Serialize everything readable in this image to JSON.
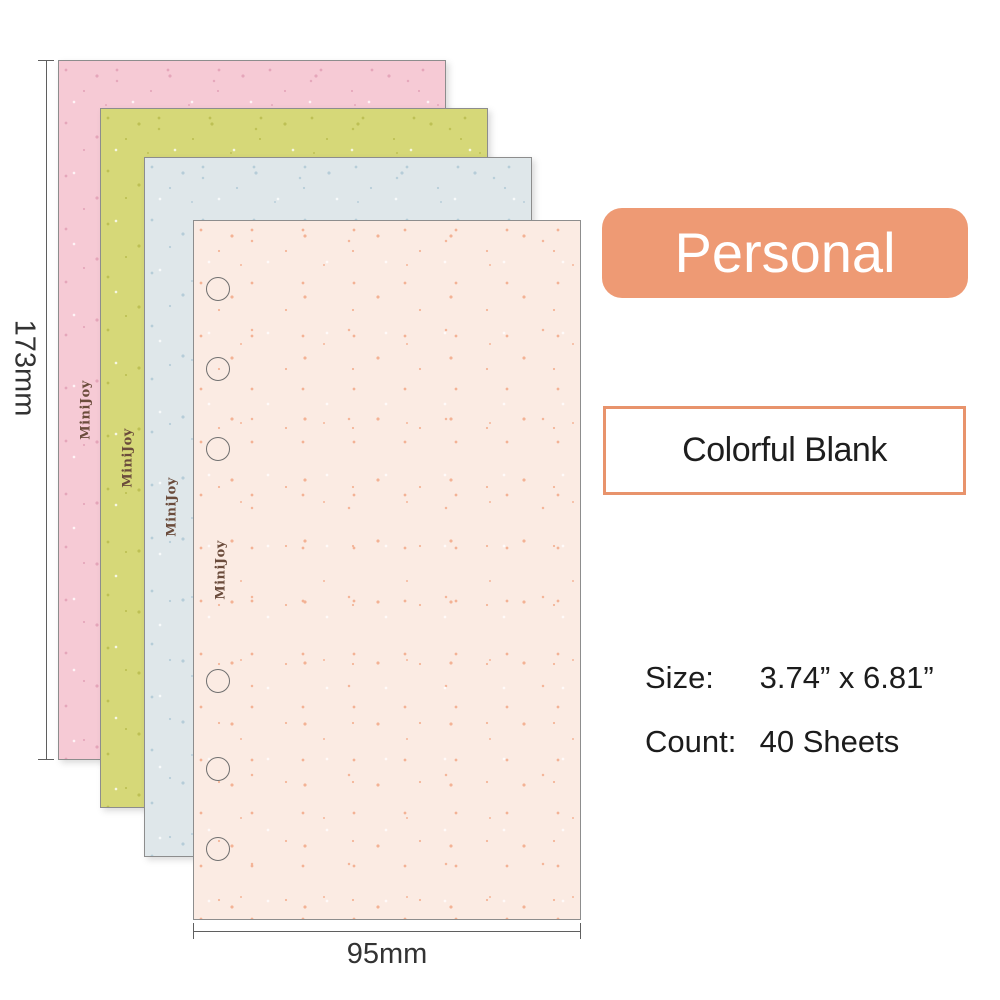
{
  "badge": {
    "label": "Personal",
    "bg": "#EE9A74",
    "text_color": "#FFFFFF"
  },
  "variant_box": {
    "label": "Colorful Blank",
    "border_color": "#E8936C"
  },
  "specs": {
    "size_label": "Size:",
    "size_value": "3.74” x 6.81”",
    "count_label": "Count:",
    "count_value": "40 Sheets"
  },
  "dimensions": {
    "height_label": "173mm",
    "width_label": "95mm"
  },
  "sheets": [
    {
      "brand": "MiniJoy",
      "color_name": "pink",
      "bg": "#F6CAD5",
      "speckle": "#E3A0B6"
    },
    {
      "brand": "MiniJoy",
      "color_name": "olive-green",
      "bg": "#D6D878",
      "speckle": "#B9BC4E"
    },
    {
      "brand": "MiniJoy",
      "color_name": "light-blue",
      "bg": "#DFE7EA",
      "speckle": "#AFC9D6"
    },
    {
      "brand": "MiniJoy",
      "color_name": "peach",
      "bg": "#FBEBE3",
      "speckle": "#F2A988"
    }
  ],
  "holes": {
    "count": 6
  }
}
